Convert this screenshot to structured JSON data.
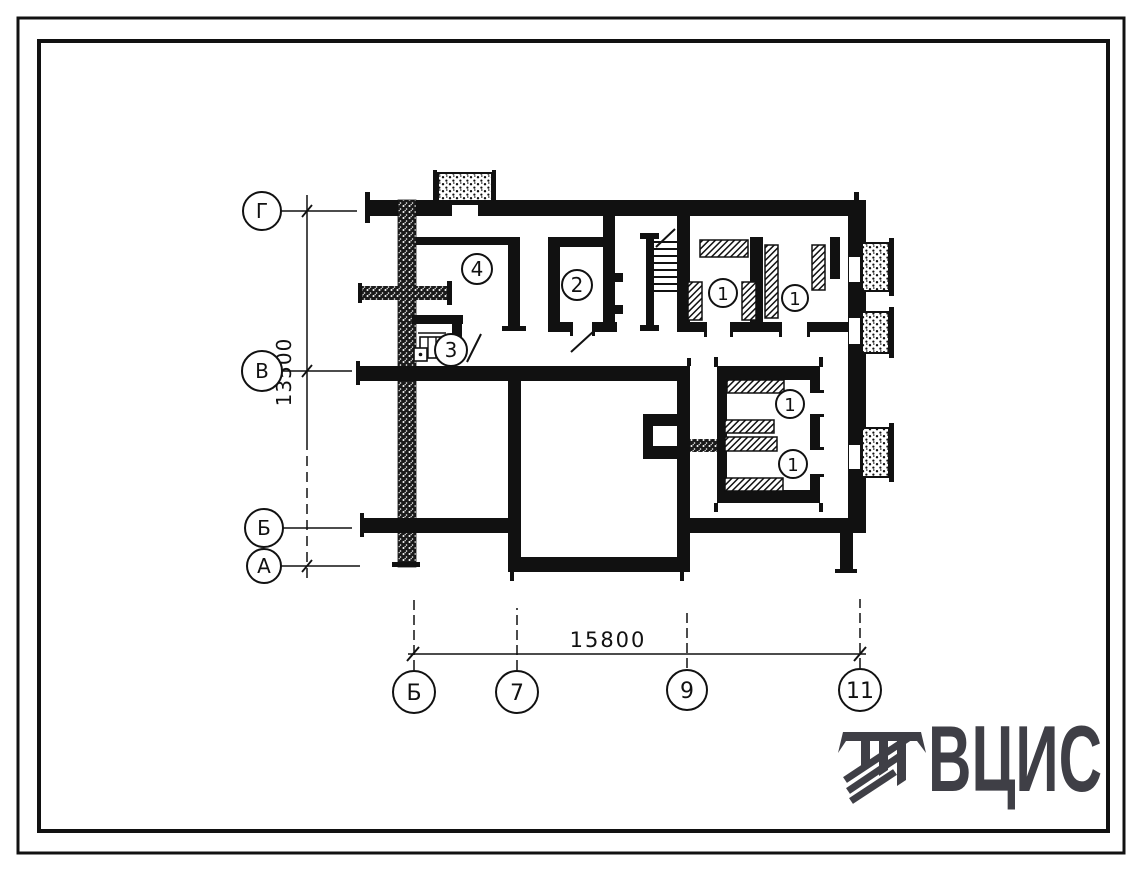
{
  "plan": {
    "rooms": [
      {
        "number": "4"
      },
      {
        "number": "2"
      },
      {
        "number": "3"
      },
      {
        "number": "1"
      },
      {
        "number": "1"
      },
      {
        "number": "1"
      },
      {
        "number": "1"
      }
    ],
    "axes_left": [
      {
        "label": "Г"
      },
      {
        "label": "В"
      },
      {
        "label": "Б"
      },
      {
        "label": "А"
      }
    ],
    "axes_bottom": [
      {
        "label": "Б"
      },
      {
        "label": "7"
      },
      {
        "label": "9"
      },
      {
        "label": "11"
      }
    ],
    "dimensions": {
      "vertical": "13500",
      "horizontal": "15800"
    }
  },
  "logo": {
    "text": "ВЦИС",
    "color": "#3f3f46"
  },
  "colors": {
    "ink": "#111111",
    "paper": "#ffffff"
  }
}
